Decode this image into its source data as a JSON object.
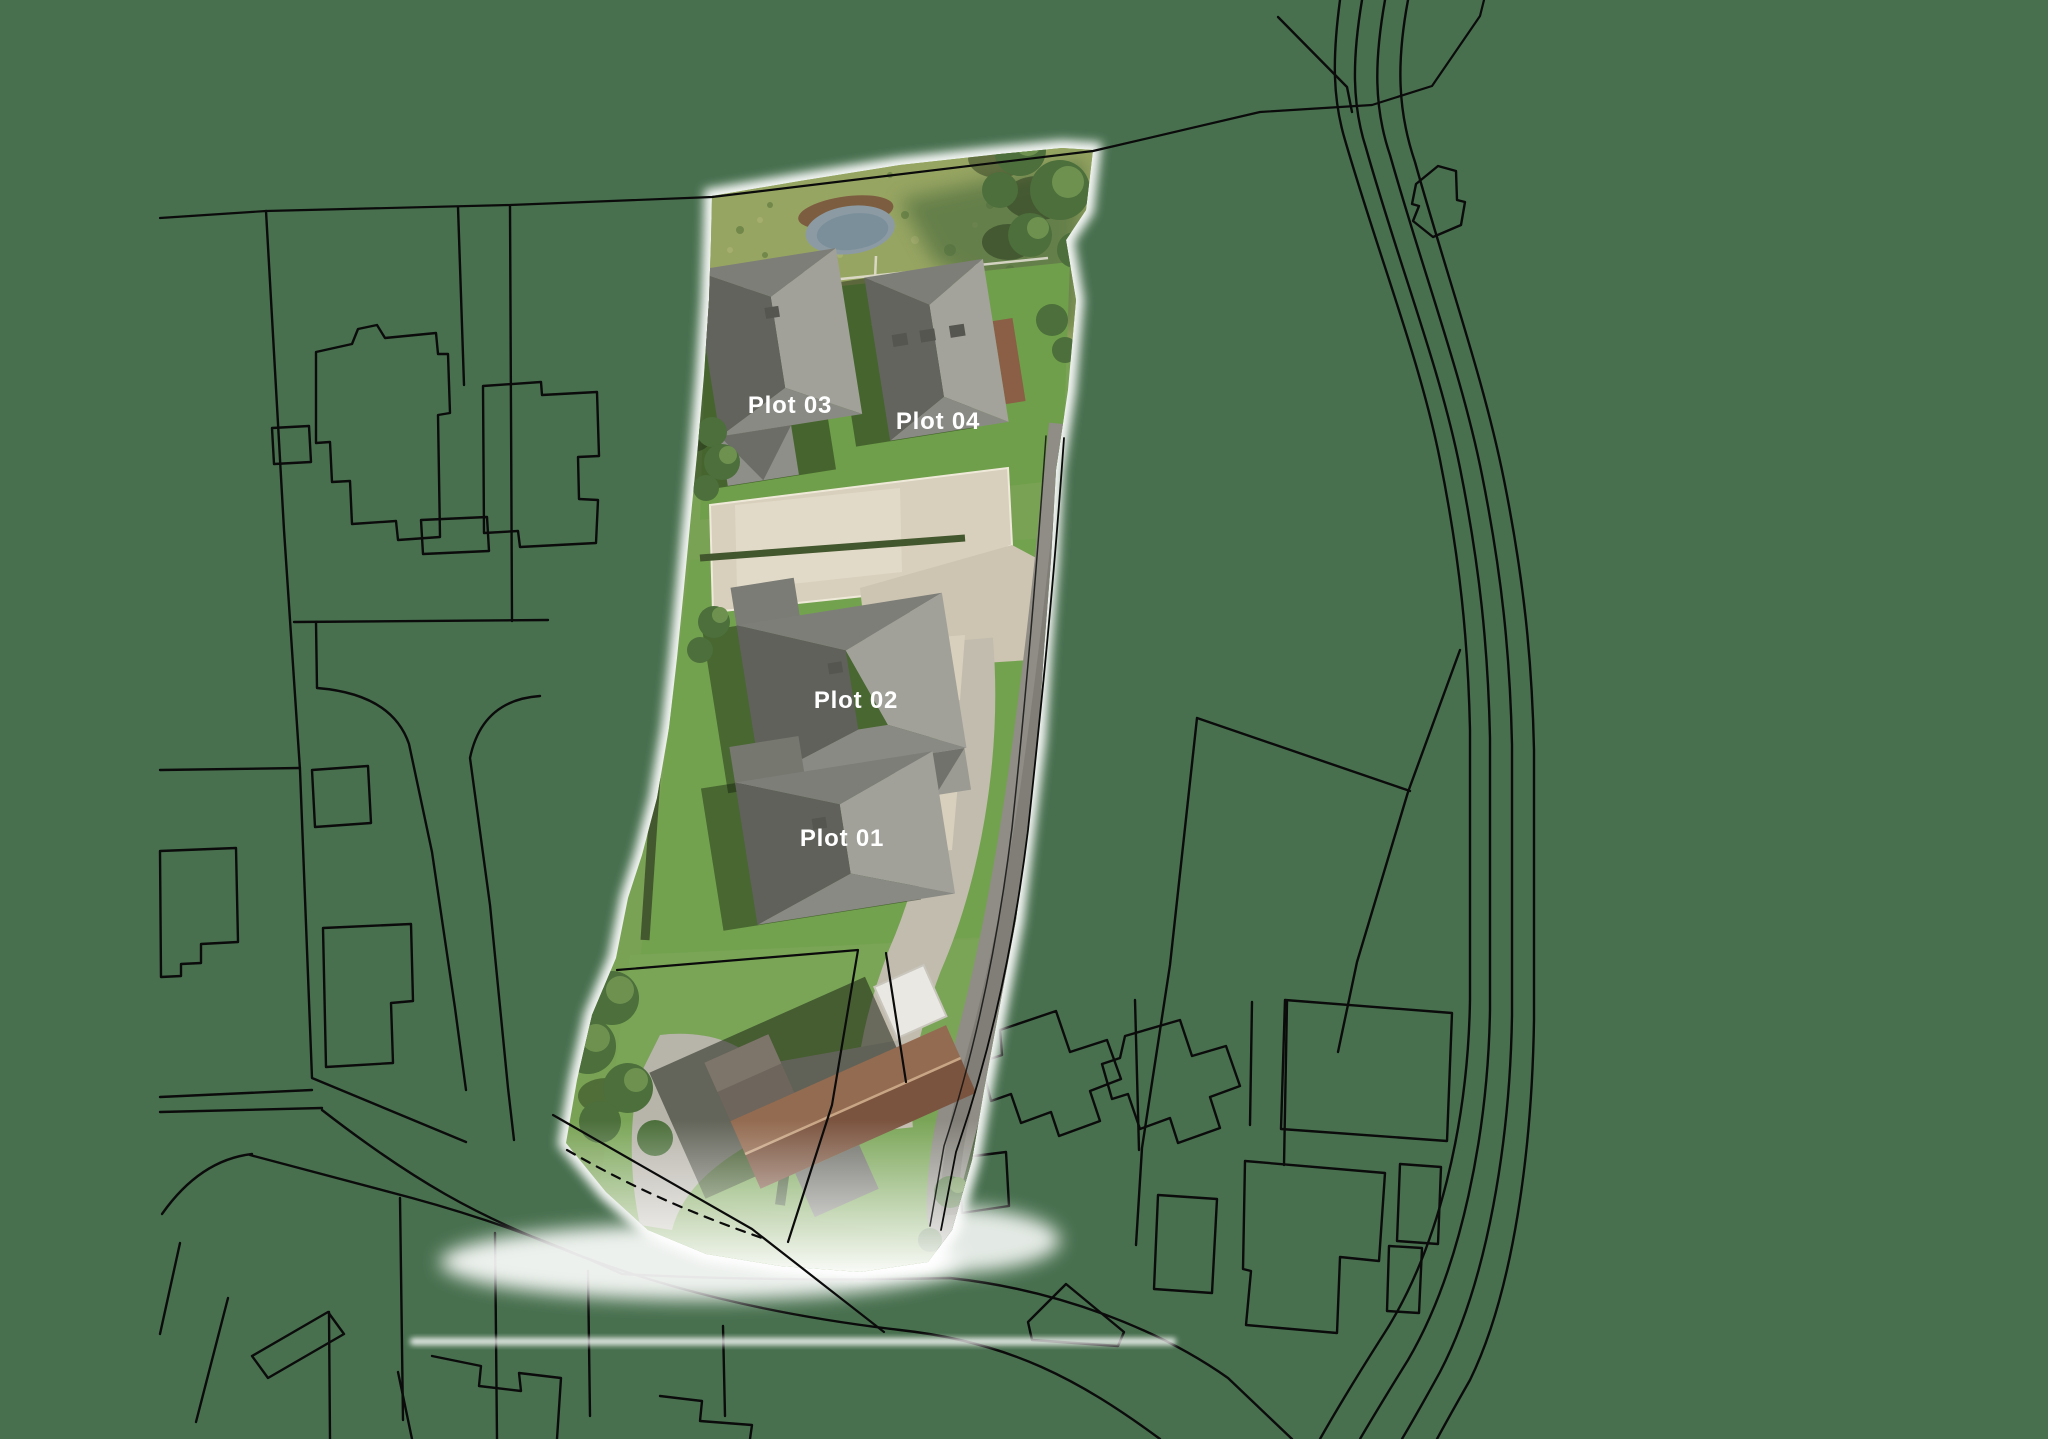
{
  "plots": [
    {
      "id": "plot-01",
      "label": "Plot 01"
    },
    {
      "id": "plot-02",
      "label": "Plot 02"
    },
    {
      "id": "plot-03",
      "label": "Plot 03"
    },
    {
      "id": "plot-04",
      "label": "Plot 04"
    }
  ],
  "colors": {
    "background": "#48704f",
    "linework": "#0b0b0b",
    "label_text": "#ffffff",
    "photo_grass": "#79a254",
    "photo_meadow": "#97a562",
    "roof_gray": "#8a8a84",
    "roof_brown": "#8f6b52",
    "driveway_beige": "#d8cfbc",
    "road_gray": "#8f8d85",
    "pond_water": "#8c9ba3"
  }
}
